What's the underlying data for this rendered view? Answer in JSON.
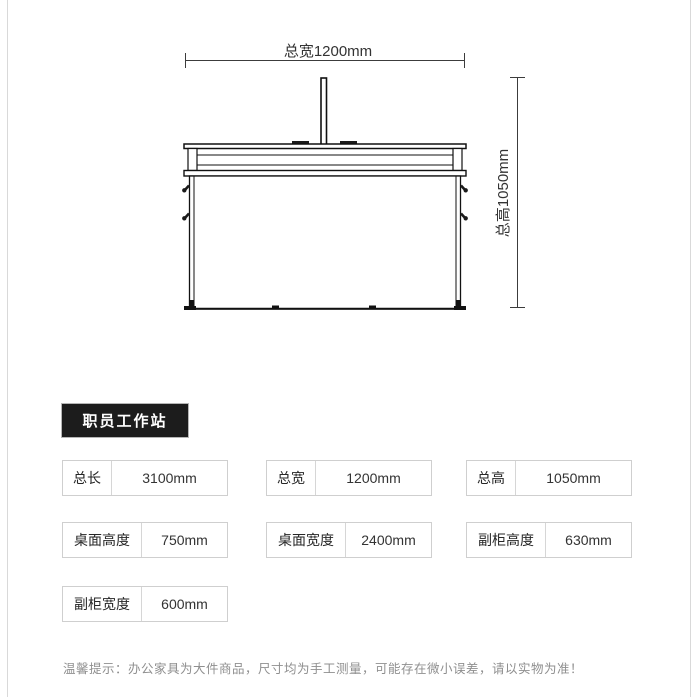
{
  "diagram": {
    "width_dimension": "总宽1200mm",
    "height_dimension": "总高1050mm"
  },
  "product": {
    "title": "职员工作站"
  },
  "specs": {
    "rows": [
      [
        {
          "label": "总长",
          "value": "3100mm"
        },
        {
          "label": "总宽",
          "value": "1200mm"
        },
        {
          "label": "总高",
          "value": "1050mm"
        }
      ],
      [
        {
          "label": "桌面高度",
          "value": "750mm"
        },
        {
          "label": "桌面宽度",
          "value": "2400mm"
        },
        {
          "label": "副柜高度",
          "value": "630mm"
        }
      ],
      [
        {
          "label": "副柜宽度",
          "value": "600mm"
        }
      ]
    ]
  },
  "footer": {
    "tip": "温馨提示：办公家具为大件商品，尺寸均为手工测量，可能存在微小误差，请以实物为准！"
  }
}
